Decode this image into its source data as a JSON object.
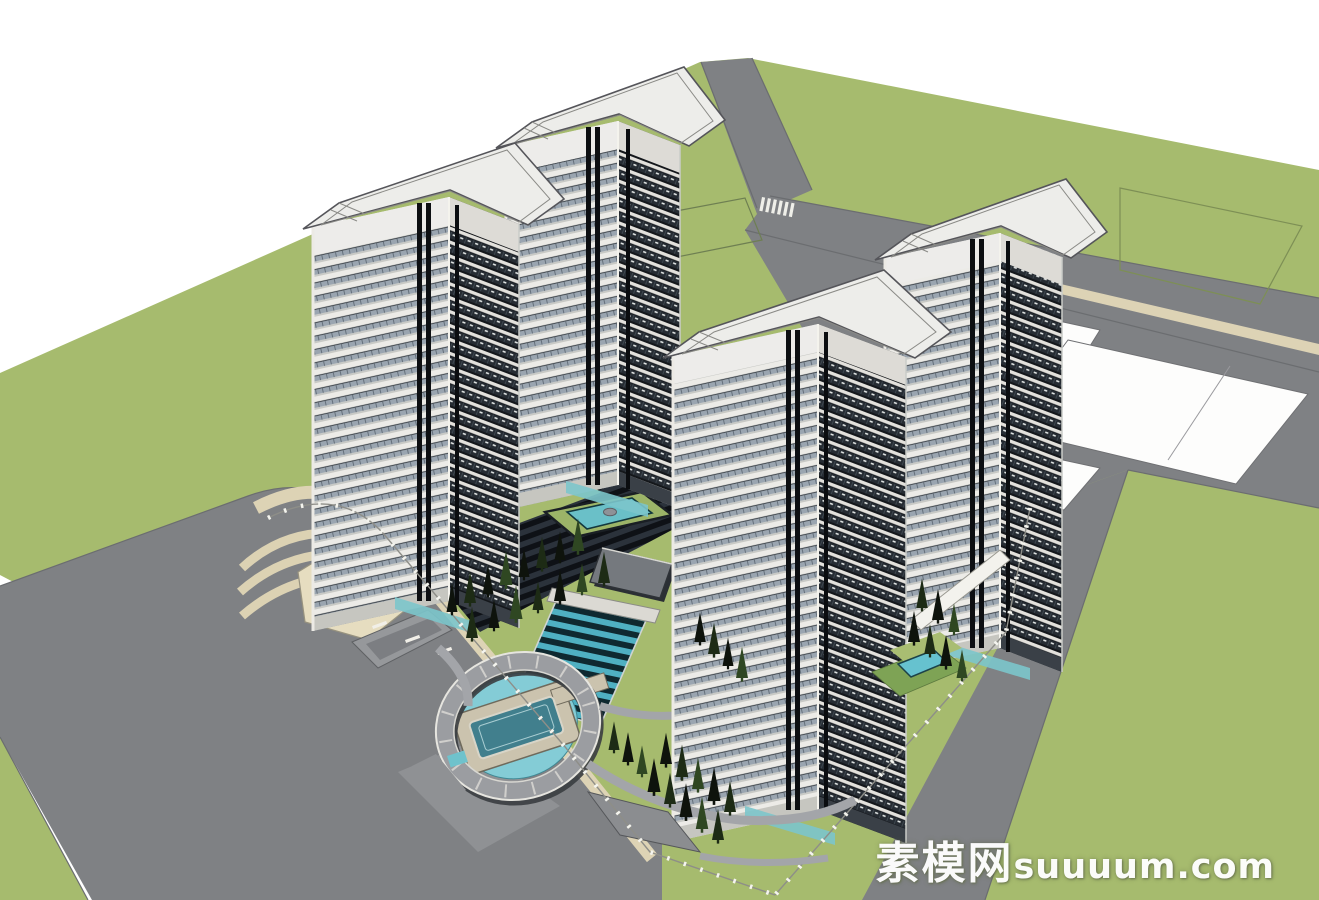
{
  "watermark": {
    "site_name_cn": "素模网",
    "site_url": "suuuum.com",
    "full_text": "素模网suuuum.com"
  },
  "scene": {
    "type": "3d-architectural-model-render",
    "style": "sketchup-massing-render",
    "towers_count": 4,
    "elements": [
      "residential-tower-back-left",
      "residential-tower-back-center",
      "residential-tower-front-center",
      "residential-tower-front-right",
      "central-water-cascade",
      "entry-drop-off-canopy",
      "podium-pool",
      "perimeter-roads",
      "lawn-parcels",
      "white-development-parcels",
      "tree-rows",
      "site-fence"
    ]
  },
  "palette": {
    "background": "#ffffff",
    "grass": "#a6bb6e",
    "road": "#7f8184",
    "sidewalk": "#ddd3b5",
    "roof_white": "#ededea",
    "facade_slab": "#ecebe7",
    "facade_glass_light": "#9aa5b0",
    "facade_glass_dark": "#262c33",
    "water_teal": "#6ac0c8",
    "cascade_teal": "#4fb0c2",
    "tree_dark": "#15200f",
    "canopy_gray": "#9b9da1"
  }
}
